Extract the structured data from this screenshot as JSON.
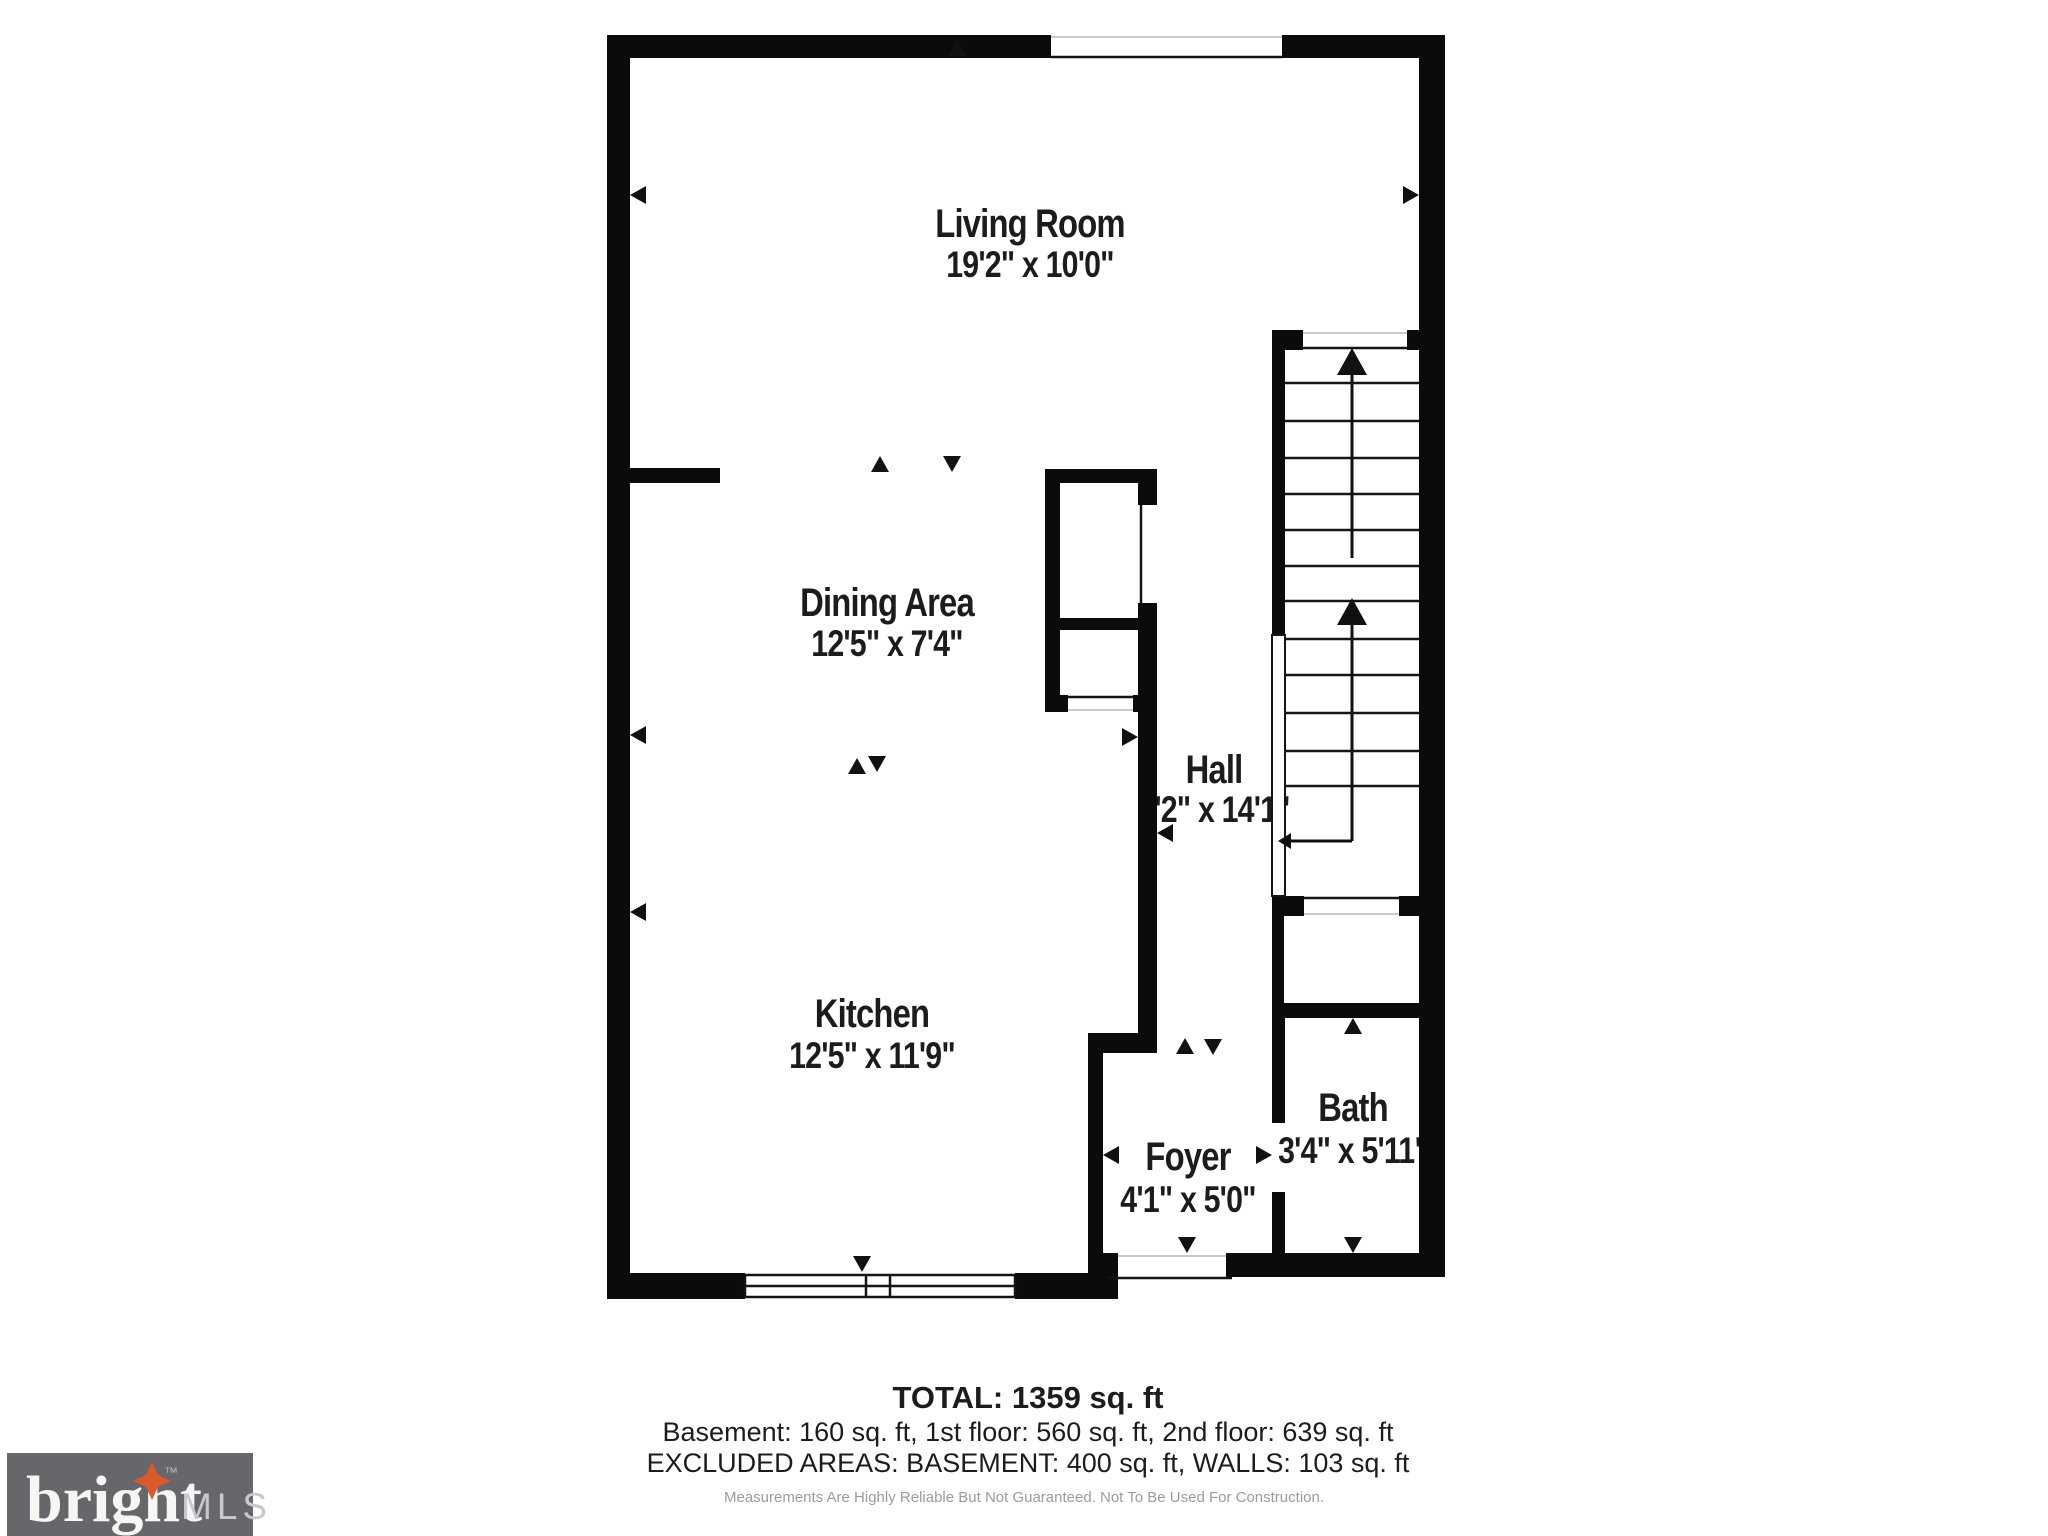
{
  "colors": {
    "walls": "#0b0b0b",
    "text": "#1c1c1c",
    "disclaimer": "#9b9b9b",
    "logo_bg": "#67676b",
    "logo_brand": "#f6f6f4",
    "logo_mls": "#c9c9cd",
    "logo_star": "#d85a2c"
  },
  "plan": {
    "rooms": [
      {
        "id": "living-room",
        "name": "Living Room",
        "dims": "19'2\" x 10'0\""
      },
      {
        "id": "dining-area",
        "name": "Dining Area",
        "dims": "12'5\" x 7'4\""
      },
      {
        "id": "hall",
        "name": "Hall",
        "dims": "3'2\" x 14'1\""
      },
      {
        "id": "kitchen",
        "name": "Kitchen",
        "dims": "12'5\" x 11'9\""
      },
      {
        "id": "foyer",
        "name": "Foyer",
        "dims": "4'1\" x 5'0\""
      },
      {
        "id": "bath",
        "name": "Bath",
        "dims": "3'4\" x 5'11\""
      }
    ]
  },
  "summary": {
    "total": "TOTAL: 1359 sq. ft",
    "floors": "Basement: 160 sq. ft, 1st floor: 560 sq. ft, 2nd floor: 639 sq. ft",
    "excluded": "EXCLUDED AREAS: BASEMENT: 400 sq. ft, WALLS: 103 sq. ft",
    "disclaimer": "Measurements Are Highly Reliable But Not Guaranteed. Not To Be Used For Construction."
  },
  "logo": {
    "brand": "bright",
    "tm": "™",
    "suffix": "MLS"
  }
}
